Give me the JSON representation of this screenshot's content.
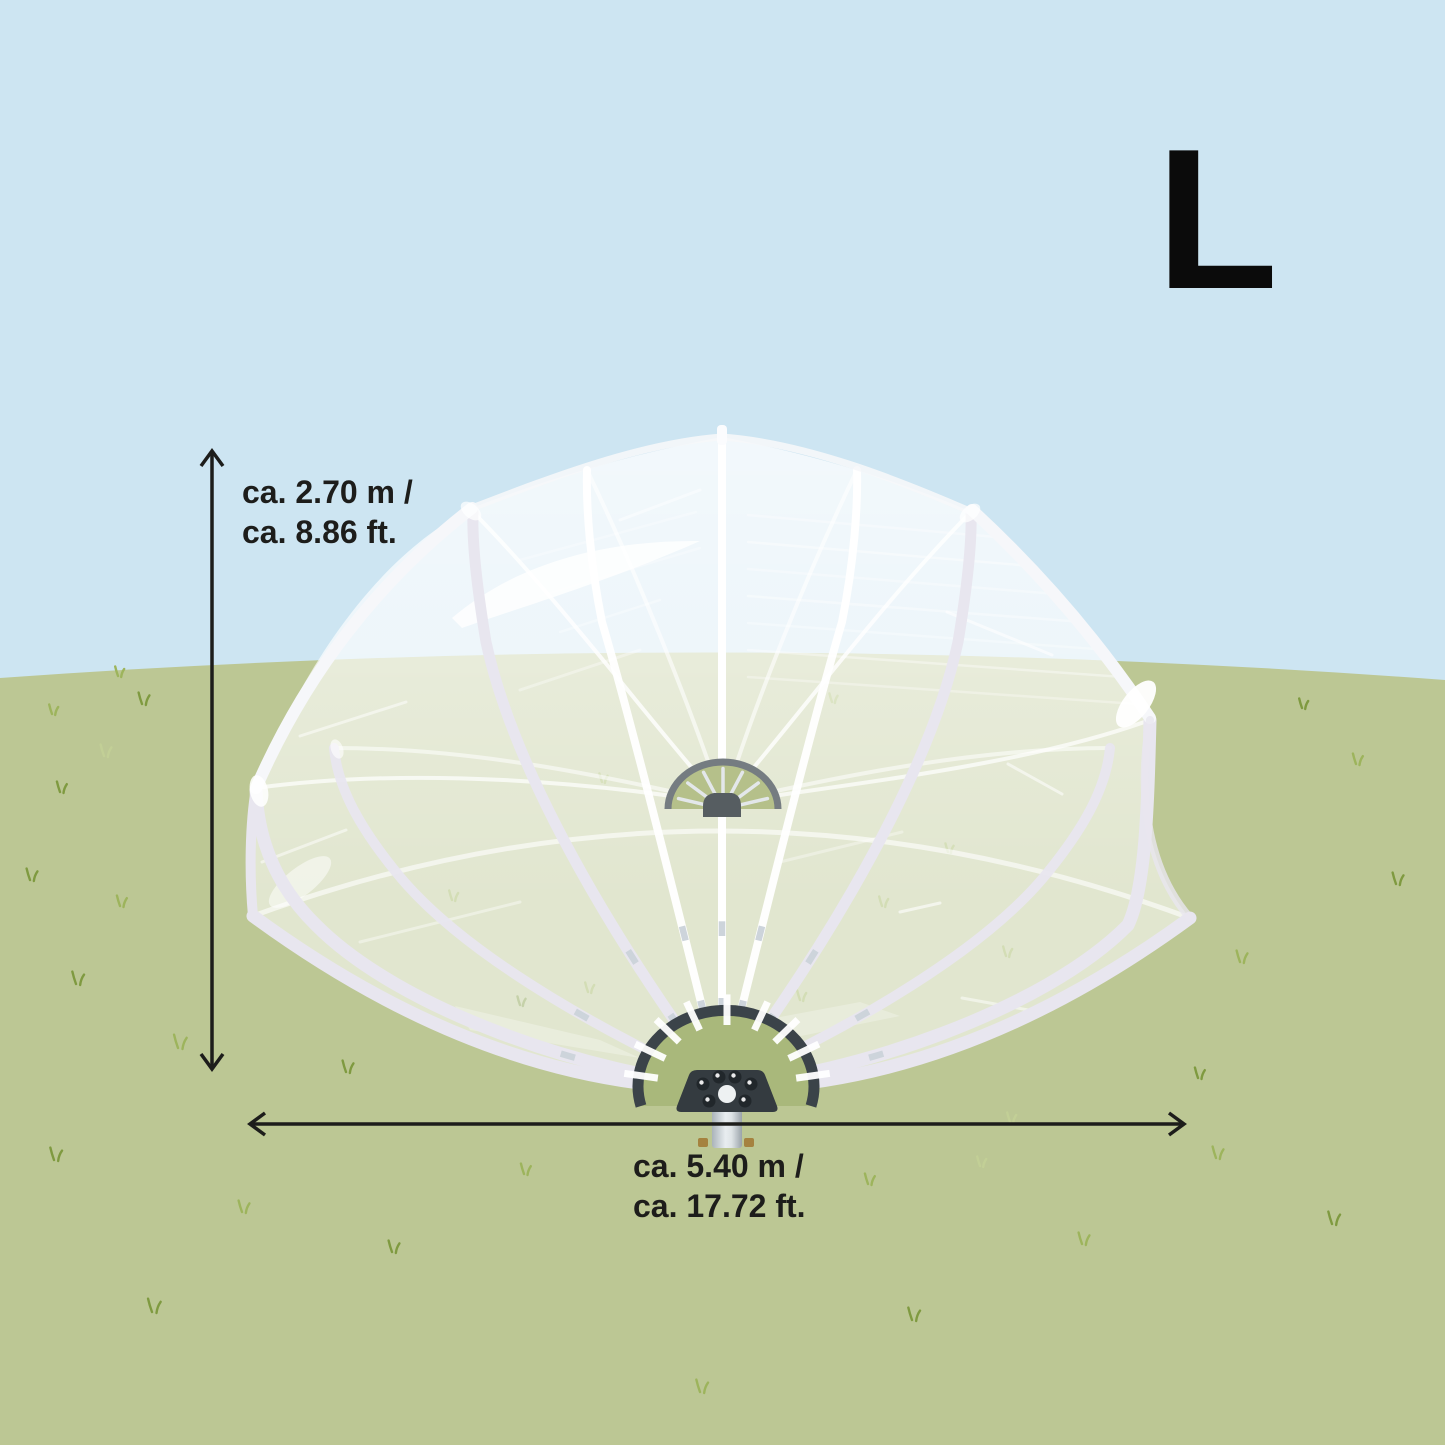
{
  "illustration": {
    "size_letter": "L",
    "height_label": {
      "line1": "ca. 2.70 m /",
      "line2": "ca. 8.86 ft."
    },
    "width_label": {
      "line1": "ca. 5.40 m /",
      "line2": "ca. 17.72 ft."
    }
  },
  "colors": {
    "sky": "#cde5f2",
    "grass": "#bcc794",
    "grass_inner_fan": "#a9b87b",
    "grass_far_fan": "#b5c08a",
    "film": "#ffffff",
    "band_light": "#e8e6ef",
    "band_white": "#f6f7fa",
    "frame_dark": "#3b4349",
    "plate_dark": "#343b40",
    "bolt_dark": "#21272b",
    "metal_silver": "#cdd4db",
    "far_arc_gray": "#757c81",
    "far_hub_gray": "#565d61",
    "cylinder_light": "#e8edf0",
    "cylinder_shade": "#aab3ba",
    "tab_brass": "#a5823f",
    "tuft_dark": "#7f9a40",
    "tuft_mid": "#9db45c",
    "tuft_light": "#c2cf96",
    "dimension_line": "#1d1d1b",
    "text": "#1d1d1b",
    "letter": "#0b0b0b"
  }
}
